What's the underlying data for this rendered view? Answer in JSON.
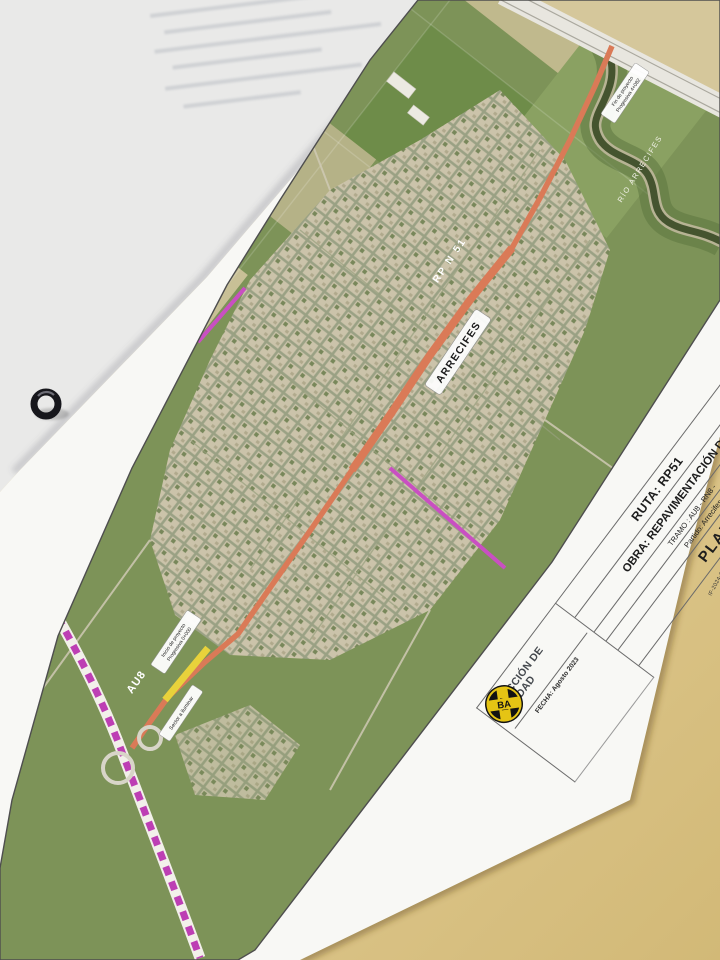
{
  "photo": {
    "desk_color": "#dfc98f",
    "sheet_color": "#f8f8f5"
  },
  "map": {
    "town_label": "ARRECIFES",
    "river_label": "RÍO ARRECIFES",
    "route_label": "RP N 51",
    "motorway_label": "AU8",
    "annotations": {
      "fin_line1": "Fin de proyecto",
      "fin_line2": "Progresiva 4+082",
      "inicio_line1": "Inicio de proyecto",
      "inicio_line2": "Progresiva 0+000",
      "sector": "Sector a iluminar"
    },
    "colors": {
      "route": "#da7a57",
      "lighting_section": "#e8d23b",
      "motorway": "#bd3fb4"
    }
  },
  "title_block": {
    "ruta": "RUTA: RP51",
    "obra": "OBRA: REPAVIMENTACIÓN DE",
    "tramo": "TRAMO : AU8 - RN8 -",
    "partido": "Partido: Arrecifes",
    "plano": "PLANO",
    "doc_ref": "IF-2024-20963049-GDEBA-DVMIYSPGP",
    "page_ref": "página 9 de 70",
    "org_line1": "DIRECCIÓN DE",
    "org_line2": "VIALIDAD",
    "fecha": "FECHA: Agosto 2023",
    "logo_top": "DV",
    "logo_bottom": "BA"
  }
}
